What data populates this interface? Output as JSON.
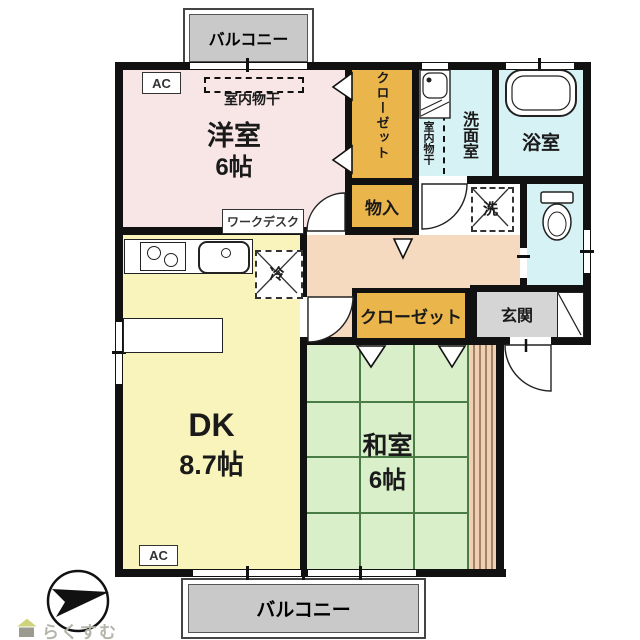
{
  "floorplan": {
    "balcony_top": {
      "label": "バルコニー"
    },
    "balcony_bottom": {
      "label": "バルコニー"
    },
    "western_room": {
      "name": "洋室",
      "size": "6帖",
      "ac_label": "AC",
      "drying_label": "室内物干",
      "desk_label": "ワークデスク"
    },
    "closet_upper": {
      "label": "クローゼット"
    },
    "storage": {
      "label": "物入"
    },
    "washroom": {
      "name": "洗面室",
      "drying_label": "室内物干"
    },
    "bathroom": {
      "name": "浴室"
    },
    "washer": {
      "label": "洗"
    },
    "fridge": {
      "label": "冷"
    },
    "closet_hall": {
      "label": "クローゼット"
    },
    "entrance": {
      "label": "玄関"
    },
    "dk": {
      "name": "DK",
      "size": "8.7帖",
      "ac_label": "AC"
    },
    "japanese_room": {
      "name": "和室",
      "size": "6帖"
    },
    "logo": {
      "text": "らくすむ"
    },
    "colors": {
      "western_room": "#f8e6e6",
      "dk": "#f9f4bb",
      "japanese_room": "#d9efca",
      "tatami_line": "#4a7d46",
      "wet_rooms": "#d7f2f5",
      "closets": "#eab54b",
      "hallway": "#f6dabf",
      "engawa_strip": "#f1cfb2",
      "balcony": "#c9c9c9",
      "entrance": "#d5d5d5",
      "walls": "#111111"
    }
  }
}
